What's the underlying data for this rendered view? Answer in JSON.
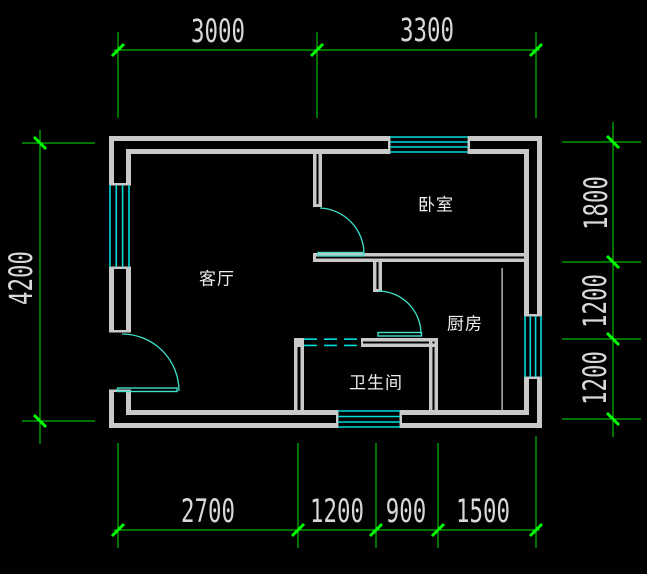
{
  "drawing": {
    "type": "floor-plan",
    "colors": {
      "background": "#000000",
      "wall": "#C9C9C9",
      "window": "#00DCDC",
      "door": "#40E2CC",
      "dimension_line": "#00E400",
      "dimension_tick": "#00FF00",
      "dimension_text": "#D8D8D8",
      "room_text": "#EFEFEF"
    },
    "rooms": [
      {
        "id": "living-room",
        "label": "客厅"
      },
      {
        "id": "bedroom",
        "label": "卧室"
      },
      {
        "id": "kitchen",
        "label": "厨房"
      },
      {
        "id": "bathroom",
        "label": "卫生间"
      }
    ],
    "dimensions": {
      "top": [
        "3000",
        "3300"
      ],
      "bottom": [
        "2700",
        "1200",
        "900",
        "1500"
      ],
      "left": [
        "4200"
      ],
      "right": [
        "1800",
        "1200",
        "1200"
      ]
    }
  }
}
